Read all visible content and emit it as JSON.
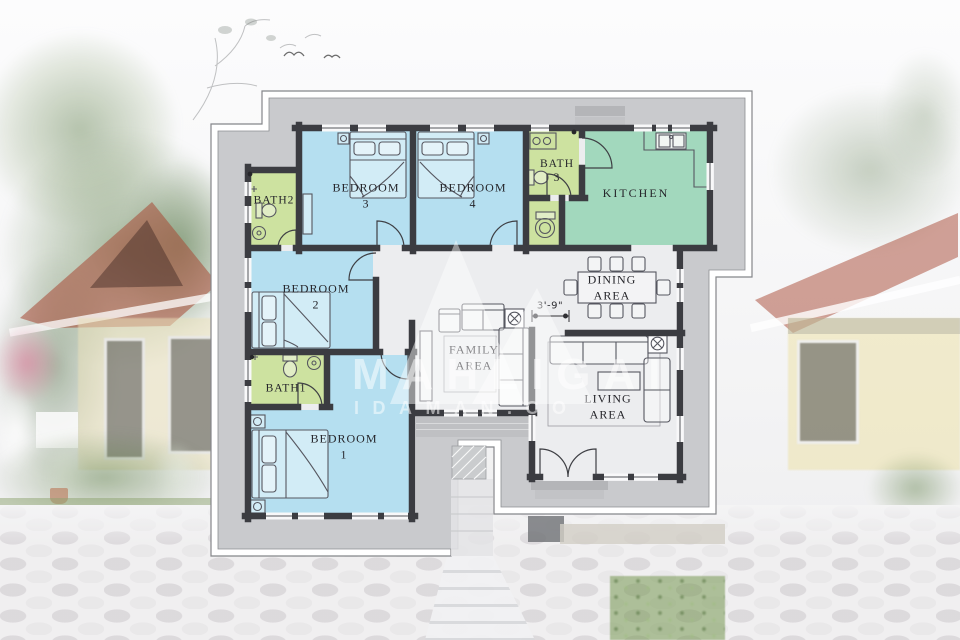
{
  "scene": {
    "type": "floor-plan-render"
  },
  "watermark": {
    "line1": "MAHLIGAI",
    "line2": "IDAMAN.CO"
  },
  "annotations": {
    "hall_width_dimension": "3'-9\""
  },
  "rooms": {
    "bedroom3": {
      "name": "BEDROOM",
      "num": "3"
    },
    "bedroom4": {
      "name": "BEDROOM",
      "num": "4"
    },
    "bedroom2": {
      "name": "BEDROOM",
      "num": "2"
    },
    "bedroom1": {
      "name": "BEDROOM",
      "num": "1"
    },
    "bath3": {
      "name": "BATH",
      "num": "3"
    },
    "bath2": {
      "name": "BATH2"
    },
    "bath1": {
      "name": "BATH1"
    },
    "kitchen": {
      "name": "KITCHEN"
    },
    "dining": {
      "line1": "DINING",
      "line2": "AREA"
    },
    "family": {
      "line1": "FAMILY",
      "line2": "AREA"
    },
    "living": {
      "line1": "LIVING",
      "line2": "AREA"
    }
  },
  "colors": {
    "bedroom_fill": "#b5dff0",
    "bath_fill": "#cde2a0",
    "kitchen_fill": "#a2d8bd",
    "wall": "#3b3c41",
    "yard": "#c9cacd",
    "floor": "#eceDef",
    "boundary": "#ffffff"
  }
}
